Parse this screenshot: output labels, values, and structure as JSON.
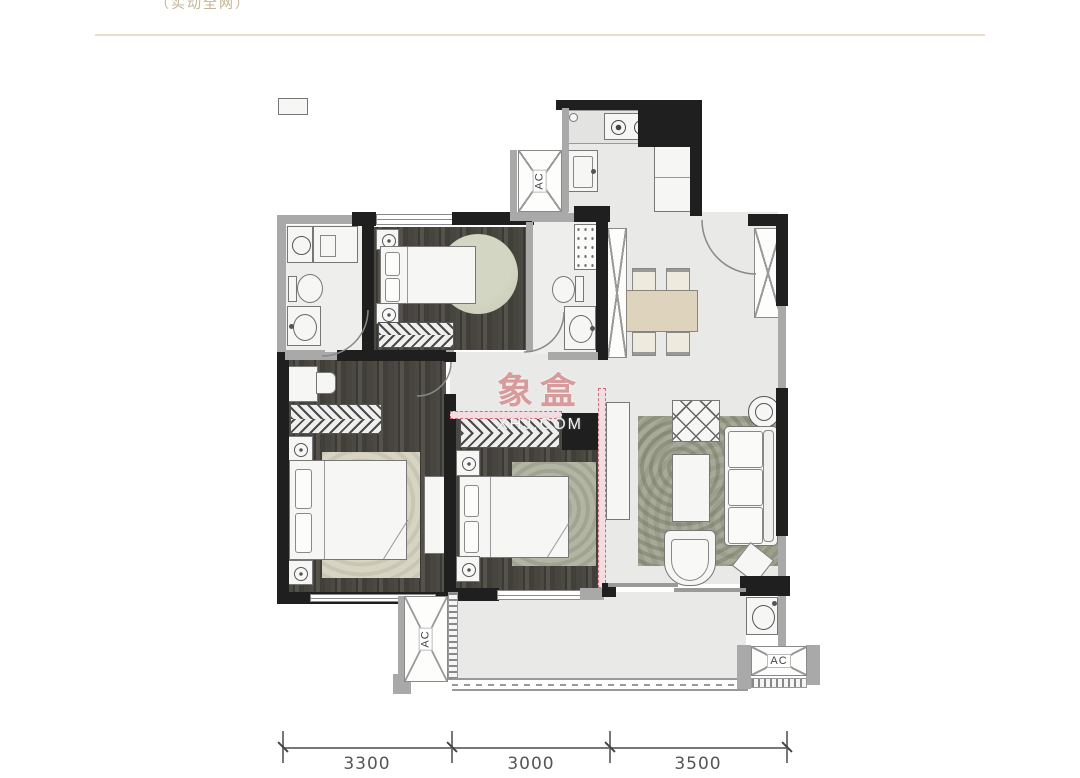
{
  "header": {
    "partial_text": "（实动全网）"
  },
  "watermark": {
    "title": "象盒",
    "subtitle": "XHJ.COM"
  },
  "hvac": {
    "label": "AC"
  },
  "dimensions": {
    "values": [
      "3300",
      "3000",
      "3500"
    ]
  },
  "colors": {
    "wall": "#1f1f1f",
    "window_wall": "#a9a9a9",
    "tile_floor": "#e9e9e7",
    "wood_floor": "#45443e",
    "dining_table": "#ded3bc",
    "living_rug": "#a7aa99",
    "pink_partition": "#d06a78",
    "header_line": "#e7dfca",
    "watermark_red": "#c97676"
  }
}
